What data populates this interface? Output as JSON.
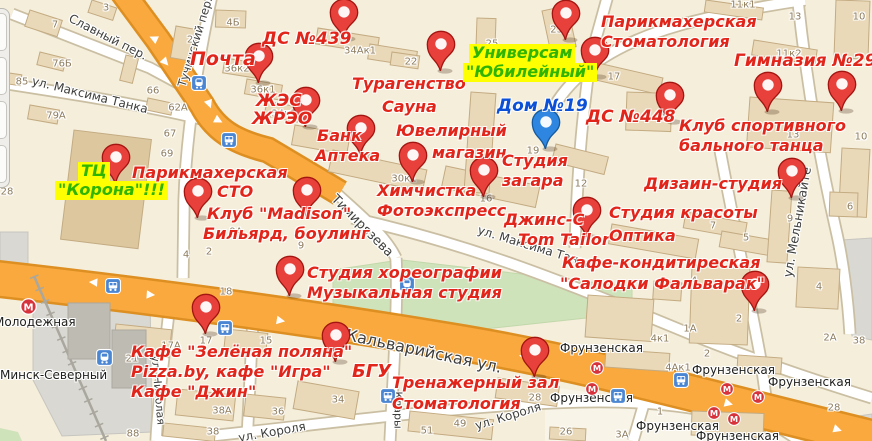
{
  "colors": {
    "land": "#f5eedb",
    "land_light": "#f8f4e8",
    "park": "#cfe3bb",
    "park_edge": "#c2d8ab",
    "road_orange": "#f9a93e",
    "road_orange_edge": "#dd8f22",
    "road_white": "#ffffff",
    "road_edge": "#cabfa3",
    "building_fill": "#ead9b9",
    "building_edge": "#c3ab82",
    "building_dark": "#dcc79f",
    "gray_zone": "#d9d8d2",
    "gray_block": "#bdbbb2",
    "rail": "#a9a79e",
    "poi_red": "#e1251b",
    "poi_green": "#2fb400",
    "poi_green_bg": "#feff00",
    "poi_blue": "#0b50d6",
    "pin_red": "#e8413c",
    "pin_red_edge": "#a31510",
    "pin_blue": "#2f86e0",
    "pin_blue_edge": "#155a9e",
    "metro_red": "#d6333d",
    "transit_blue": "#4b86d2"
  },
  "glyphs": {
    "arrow": "▶",
    "metro_letter": "М"
  },
  "poi_labels": [
    {
      "t": "Почта",
      "x": 190,
      "y": 50,
      "c": "red",
      "s": 19
    },
    {
      "t": "ДС №439",
      "x": 262,
      "y": 31,
      "c": "red",
      "s": 17
    },
    {
      "t": "ЖЭС",
      "x": 256,
      "y": 93,
      "c": "red",
      "s": 17
    },
    {
      "t": "ЖРЭО",
      "x": 252,
      "y": 111,
      "c": "red",
      "s": 17
    },
    {
      "t": "Турагенство",
      "x": 352,
      "y": 76,
      "c": "red"
    },
    {
      "t": "Сауна",
      "x": 382,
      "y": 99,
      "c": "red"
    },
    {
      "t": "Универсам",
      "x": 470,
      "y": 45,
      "c": "green"
    },
    {
      "t": "\"Юбилейный\"",
      "x": 464,
      "y": 64,
      "c": "green"
    },
    {
      "t": "Дом №19",
      "x": 497,
      "y": 98,
      "c": "blue",
      "s": 17
    },
    {
      "t": "Парикмахерская",
      "x": 601,
      "y": 14,
      "c": "red"
    },
    {
      "t": "Стоматология",
      "x": 601,
      "y": 34,
      "c": "red"
    },
    {
      "t": "Гимназия №29",
      "x": 734,
      "y": 53,
      "c": "red",
      "s": 17
    },
    {
      "t": "ДС №448",
      "x": 586,
      "y": 109,
      "c": "red",
      "s": 17
    },
    {
      "t": "Клуб спортивного",
      "x": 679,
      "y": 118,
      "c": "red"
    },
    {
      "t": "бального танца",
      "x": 679,
      "y": 138,
      "c": "red"
    },
    {
      "t": "ТЦ",
      "x": 79,
      "y": 163,
      "c": "green"
    },
    {
      "t": "\"Корона\"!!!",
      "x": 56,
      "y": 182,
      "c": "green"
    },
    {
      "t": "Парикмахерская",
      "x": 132,
      "y": 165,
      "c": "red"
    },
    {
      "t": "СТО",
      "x": 217,
      "y": 184,
      "c": "red"
    },
    {
      "t": "Клуб \"Madison\"",
      "x": 207,
      "y": 206,
      "c": "red"
    },
    {
      "t": "Бильярд, боулинг",
      "x": 203,
      "y": 226,
      "c": "red"
    },
    {
      "t": "Банк",
      "x": 317,
      "y": 128,
      "c": "red"
    },
    {
      "t": "Аптека",
      "x": 315,
      "y": 148,
      "c": "red"
    },
    {
      "t": "Ювелирный",
      "x": 396,
      "y": 123,
      "c": "red"
    },
    {
      "t": "магазин",
      "x": 432,
      "y": 145,
      "c": "red"
    },
    {
      "t": "Химчистка",
      "x": 377,
      "y": 183,
      "c": "red"
    },
    {
      "t": "Фотоэкспресс",
      "x": 377,
      "y": 203,
      "c": "red"
    },
    {
      "t": "Студия",
      "x": 502,
      "y": 153,
      "c": "red"
    },
    {
      "t": "загара",
      "x": 502,
      "y": 173,
      "c": "red"
    },
    {
      "t": "Джинс-С",
      "x": 504,
      "y": 212,
      "c": "red"
    },
    {
      "t": "Tom Tailor",
      "x": 518,
      "y": 232,
      "c": "red"
    },
    {
      "t": "Студия красоты",
      "x": 609,
      "y": 205,
      "c": "red"
    },
    {
      "t": "Оптика",
      "x": 609,
      "y": 228,
      "c": "red"
    },
    {
      "t": "Дизаин-студия",
      "x": 644,
      "y": 176,
      "c": "red"
    },
    {
      "t": "Кафе-кондитиреская",
      "x": 562,
      "y": 255,
      "c": "red"
    },
    {
      "t": "\"Салодки Фальварак\"",
      "x": 560,
      "y": 276,
      "c": "red"
    },
    {
      "t": "Студия хореографии",
      "x": 307,
      "y": 265,
      "c": "red"
    },
    {
      "t": "Музыкальная студия",
      "x": 307,
      "y": 285,
      "c": "red"
    },
    {
      "t": "Кафе \"Зелёная поляна\"",
      "x": 131,
      "y": 344,
      "c": "red"
    },
    {
      "t": "Pizza.by, кафе \"Игра\"",
      "x": 131,
      "y": 364,
      "c": "red"
    },
    {
      "t": "Кафе \"Джин\"",
      "x": 131,
      "y": 384,
      "c": "red"
    },
    {
      "t": "БГУ",
      "x": 352,
      "y": 363,
      "c": "red",
      "s": 18
    },
    {
      "t": "Тренажерный зал",
      "x": 392,
      "y": 375,
      "c": "red"
    },
    {
      "t": "Стоматология",
      "x": 392,
      "y": 396,
      "c": "red"
    }
  ],
  "pins": [
    {
      "x": 258,
      "y": 83,
      "c": "red"
    },
    {
      "x": 305,
      "y": 127,
      "c": "red"
    },
    {
      "x": 343,
      "y": 39,
      "c": "red"
    },
    {
      "x": 440,
      "y": 71,
      "c": "red"
    },
    {
      "x": 594,
      "y": 77,
      "c": "red"
    },
    {
      "x": 565,
      "y": 40,
      "c": "red"
    },
    {
      "x": 767,
      "y": 112,
      "c": "red"
    },
    {
      "x": 669,
      "y": 122,
      "c": "red"
    },
    {
      "x": 841,
      "y": 111,
      "c": "red"
    },
    {
      "x": 545,
      "y": 149,
      "c": "blue"
    },
    {
      "x": 115,
      "y": 184,
      "c": "red"
    },
    {
      "x": 197,
      "y": 218,
      "c": "red"
    },
    {
      "x": 306,
      "y": 217,
      "c": "red"
    },
    {
      "x": 360,
      "y": 155,
      "c": "red"
    },
    {
      "x": 412,
      "y": 182,
      "c": "red"
    },
    {
      "x": 483,
      "y": 197,
      "c": "red"
    },
    {
      "x": 586,
      "y": 237,
      "c": "red"
    },
    {
      "x": 791,
      "y": 198,
      "c": "red"
    },
    {
      "x": 754,
      "y": 311,
      "c": "red"
    },
    {
      "x": 289,
      "y": 296,
      "c": "red"
    },
    {
      "x": 205,
      "y": 334,
      "c": "red"
    },
    {
      "x": 335,
      "y": 362,
      "c": "red"
    },
    {
      "x": 534,
      "y": 377,
      "c": "red"
    }
  ],
  "street_labels": [
    {
      "t": "Славный пер.",
      "x": 108,
      "y": 37,
      "r": 27,
      "s": 12
    },
    {
      "t": "ул. Максима Танка",
      "x": 90,
      "y": 95,
      "r": 14,
      "s": 12
    },
    {
      "t": "Тучинский пер.",
      "x": 195,
      "y": 42,
      "r": -73,
      "s": 11.5
    },
    {
      "t": "Тимирязева",
      "x": 362,
      "y": 226,
      "r": 45,
      "s": 13
    },
    {
      "t": "ул. Максима Танка",
      "x": 535,
      "y": 247,
      "r": 17,
      "s": 12
    },
    {
      "t": "ул. Мельникайте",
      "x": 797,
      "y": 222,
      "r": -80,
      "s": 12.5
    },
    {
      "t": "Кальварийская ул.",
      "x": 424,
      "y": 351,
      "r": 12,
      "s": 16
    },
    {
      "t": "ул. Короля",
      "x": 508,
      "y": 416,
      "r": -17,
      "s": 12
    },
    {
      "t": "ул. Короля",
      "x": 272,
      "y": 432,
      "r": -10,
      "s": 12
    },
    {
      "t": "Клары",
      "x": 398,
      "y": 410,
      "r": 90,
      "s": 11
    },
    {
      "t": "ул. Николая",
      "x": 158,
      "y": 390,
      "r": 85,
      "s": 11
    }
  ],
  "building_numbers": [
    {
      "t": "7",
      "x": 55,
      "y": 25
    },
    {
      "t": "3",
      "x": 106,
      "y": 8
    },
    {
      "t": "2",
      "x": 190,
      "y": 40
    },
    {
      "t": "4Б",
      "x": 233,
      "y": 23
    },
    {
      "t": "76Б",
      "x": 62,
      "y": 64
    },
    {
      "t": "85",
      "x": 22,
      "y": 82
    },
    {
      "t": "66",
      "x": 153,
      "y": 91
    },
    {
      "t": "62А",
      "x": 178,
      "y": 108
    },
    {
      "t": "79А",
      "x": 56,
      "y": 116
    },
    {
      "t": "36к2",
      "x": 237,
      "y": 69
    },
    {
      "t": "36к1",
      "x": 263,
      "y": 90
    },
    {
      "t": "34к1",
      "x": 284,
      "y": 114
    },
    {
      "t": "34Ак1",
      "x": 360,
      "y": 51
    },
    {
      "t": "22",
      "x": 411,
      "y": 62
    },
    {
      "t": "25",
      "x": 492,
      "y": 44
    },
    {
      "t": "23А",
      "x": 560,
      "y": 30
    },
    {
      "t": "11к1",
      "x": 743,
      "y": 5
    },
    {
      "t": "11к2",
      "x": 789,
      "y": 54
    },
    {
      "t": "17",
      "x": 614,
      "y": 77
    },
    {
      "t": "13",
      "x": 795,
      "y": 17
    },
    {
      "t": "10",
      "x": 859,
      "y": 17
    },
    {
      "t": "13",
      "x": 667,
      "y": 118
    },
    {
      "t": "13",
      "x": 793,
      "y": 135
    },
    {
      "t": "10",
      "x": 861,
      "y": 137
    },
    {
      "t": "67",
      "x": 170,
      "y": 134
    },
    {
      "t": "69",
      "x": 167,
      "y": 154
    },
    {
      "t": "28",
      "x": 7,
      "y": 192
    },
    {
      "t": "9А",
      "x": 236,
      "y": 232
    },
    {
      "t": "4",
      "x": 186,
      "y": 255
    },
    {
      "t": "2",
      "x": 209,
      "y": 252
    },
    {
      "t": "9",
      "x": 301,
      "y": 246
    },
    {
      "t": "30к1",
      "x": 404,
      "y": 179
    },
    {
      "t": "16",
      "x": 486,
      "y": 199
    },
    {
      "t": "12",
      "x": 581,
      "y": 184
    },
    {
      "t": "19",
      "x": 533,
      "y": 151
    },
    {
      "t": "9",
      "x": 790,
      "y": 219
    },
    {
      "t": "7",
      "x": 713,
      "y": 226
    },
    {
      "t": "5",
      "x": 746,
      "y": 238
    },
    {
      "t": "6",
      "x": 850,
      "y": 207
    },
    {
      "t": "18",
      "x": 226,
      "y": 292
    },
    {
      "t": "17А",
      "x": 171,
      "y": 346
    },
    {
      "t": "17",
      "x": 206,
      "y": 341
    },
    {
      "t": "15",
      "x": 266,
      "y": 341
    },
    {
      "t": "21",
      "x": 132,
      "y": 359
    },
    {
      "t": "34",
      "x": 338,
      "y": 400
    },
    {
      "t": "38А",
      "x": 222,
      "y": 411
    },
    {
      "t": "36",
      "x": 278,
      "y": 412
    },
    {
      "t": "38",
      "x": 213,
      "y": 432
    },
    {
      "t": "88",
      "x": 133,
      "y": 434
    },
    {
      "t": "49",
      "x": 460,
      "y": 424
    },
    {
      "t": "51",
      "x": 427,
      "y": 431
    },
    {
      "t": "28",
      "x": 535,
      "y": 398
    },
    {
      "t": "26",
      "x": 566,
      "y": 432
    },
    {
      "t": "4",
      "x": 694,
      "y": 281
    },
    {
      "t": "4",
      "x": 819,
      "y": 287
    },
    {
      "t": "2",
      "x": 739,
      "y": 319
    },
    {
      "t": "1А",
      "x": 690,
      "y": 329
    },
    {
      "t": "4к1",
      "x": 660,
      "y": 339
    },
    {
      "t": "2",
      "x": 707,
      "y": 354
    },
    {
      "t": "2А",
      "x": 830,
      "y": 338
    },
    {
      "t": "38",
      "x": 859,
      "y": 341
    },
    {
      "t": "4Ак1",
      "x": 678,
      "y": 368
    },
    {
      "t": "1",
      "x": 660,
      "y": 412
    },
    {
      "t": "3А",
      "x": 622,
      "y": 435
    },
    {
      "t": "28",
      "x": 834,
      "y": 408
    }
  ],
  "station_labels": [
    {
      "t": "Молодежная",
      "x": -6,
      "y": 315
    },
    {
      "t": "Минск-Северный",
      "x": 0,
      "y": 368
    },
    {
      "t": "Фрунзенская",
      "x": 560,
      "y": 341
    },
    {
      "t": "Фрунзенская",
      "x": 692,
      "y": 363
    },
    {
      "t": "Фрунзенская",
      "x": 768,
      "y": 375
    },
    {
      "t": "Фрунзенская",
      "x": 550,
      "y": 391
    },
    {
      "t": "Фрунзенская",
      "x": 636,
      "y": 419
    },
    {
      "t": "Фрунзенская",
      "x": 696,
      "y": 429
    }
  ],
  "transit_icons": [
    {
      "type": "metro",
      "x": 28,
      "y": 306,
      "s": 17
    },
    {
      "type": "train",
      "x": 104,
      "y": 357,
      "s": 17
    },
    {
      "type": "train",
      "x": 199,
      "y": 83,
      "s": 16
    },
    {
      "type": "bus",
      "x": 229,
      "y": 140,
      "s": 16
    },
    {
      "type": "bus",
      "x": 113,
      "y": 286,
      "s": 16
    },
    {
      "type": "bus",
      "x": 225,
      "y": 328,
      "s": 16
    },
    {
      "type": "train",
      "x": 407,
      "y": 284,
      "s": 16
    },
    {
      "type": "bus",
      "x": 388,
      "y": 396,
      "s": 16
    },
    {
      "type": "bus",
      "x": 618,
      "y": 396,
      "s": 16
    },
    {
      "type": "bus",
      "x": 681,
      "y": 380,
      "s": 16
    },
    {
      "type": "metro",
      "x": 597,
      "y": 368,
      "s": 14
    },
    {
      "type": "metro",
      "x": 592,
      "y": 389,
      "s": 14
    },
    {
      "type": "metro",
      "x": 727,
      "y": 389,
      "s": 14
    },
    {
      "type": "metro",
      "x": 758,
      "y": 397,
      "s": 14
    },
    {
      "type": "metro",
      "x": 714,
      "y": 413,
      "s": 14
    },
    {
      "type": "metro",
      "x": 734,
      "y": 419,
      "s": 14
    }
  ],
  "road_arrows": [
    {
      "x": 153,
      "y": 39,
      "r": 205
    },
    {
      "x": 166,
      "y": 62,
      "r": 48
    },
    {
      "x": 210,
      "y": 104,
      "r": 70
    },
    {
      "x": 219,
      "y": 120,
      "r": 28
    },
    {
      "x": 93,
      "y": 283,
      "r": 184
    },
    {
      "x": 151,
      "y": 294,
      "r": 4
    },
    {
      "x": 281,
      "y": 320,
      "r": 10
    },
    {
      "x": 523,
      "y": 357,
      "r": 192
    },
    {
      "x": 729,
      "y": 403,
      "r": 15
    },
    {
      "x": 838,
      "y": 429,
      "r": 18
    }
  ]
}
